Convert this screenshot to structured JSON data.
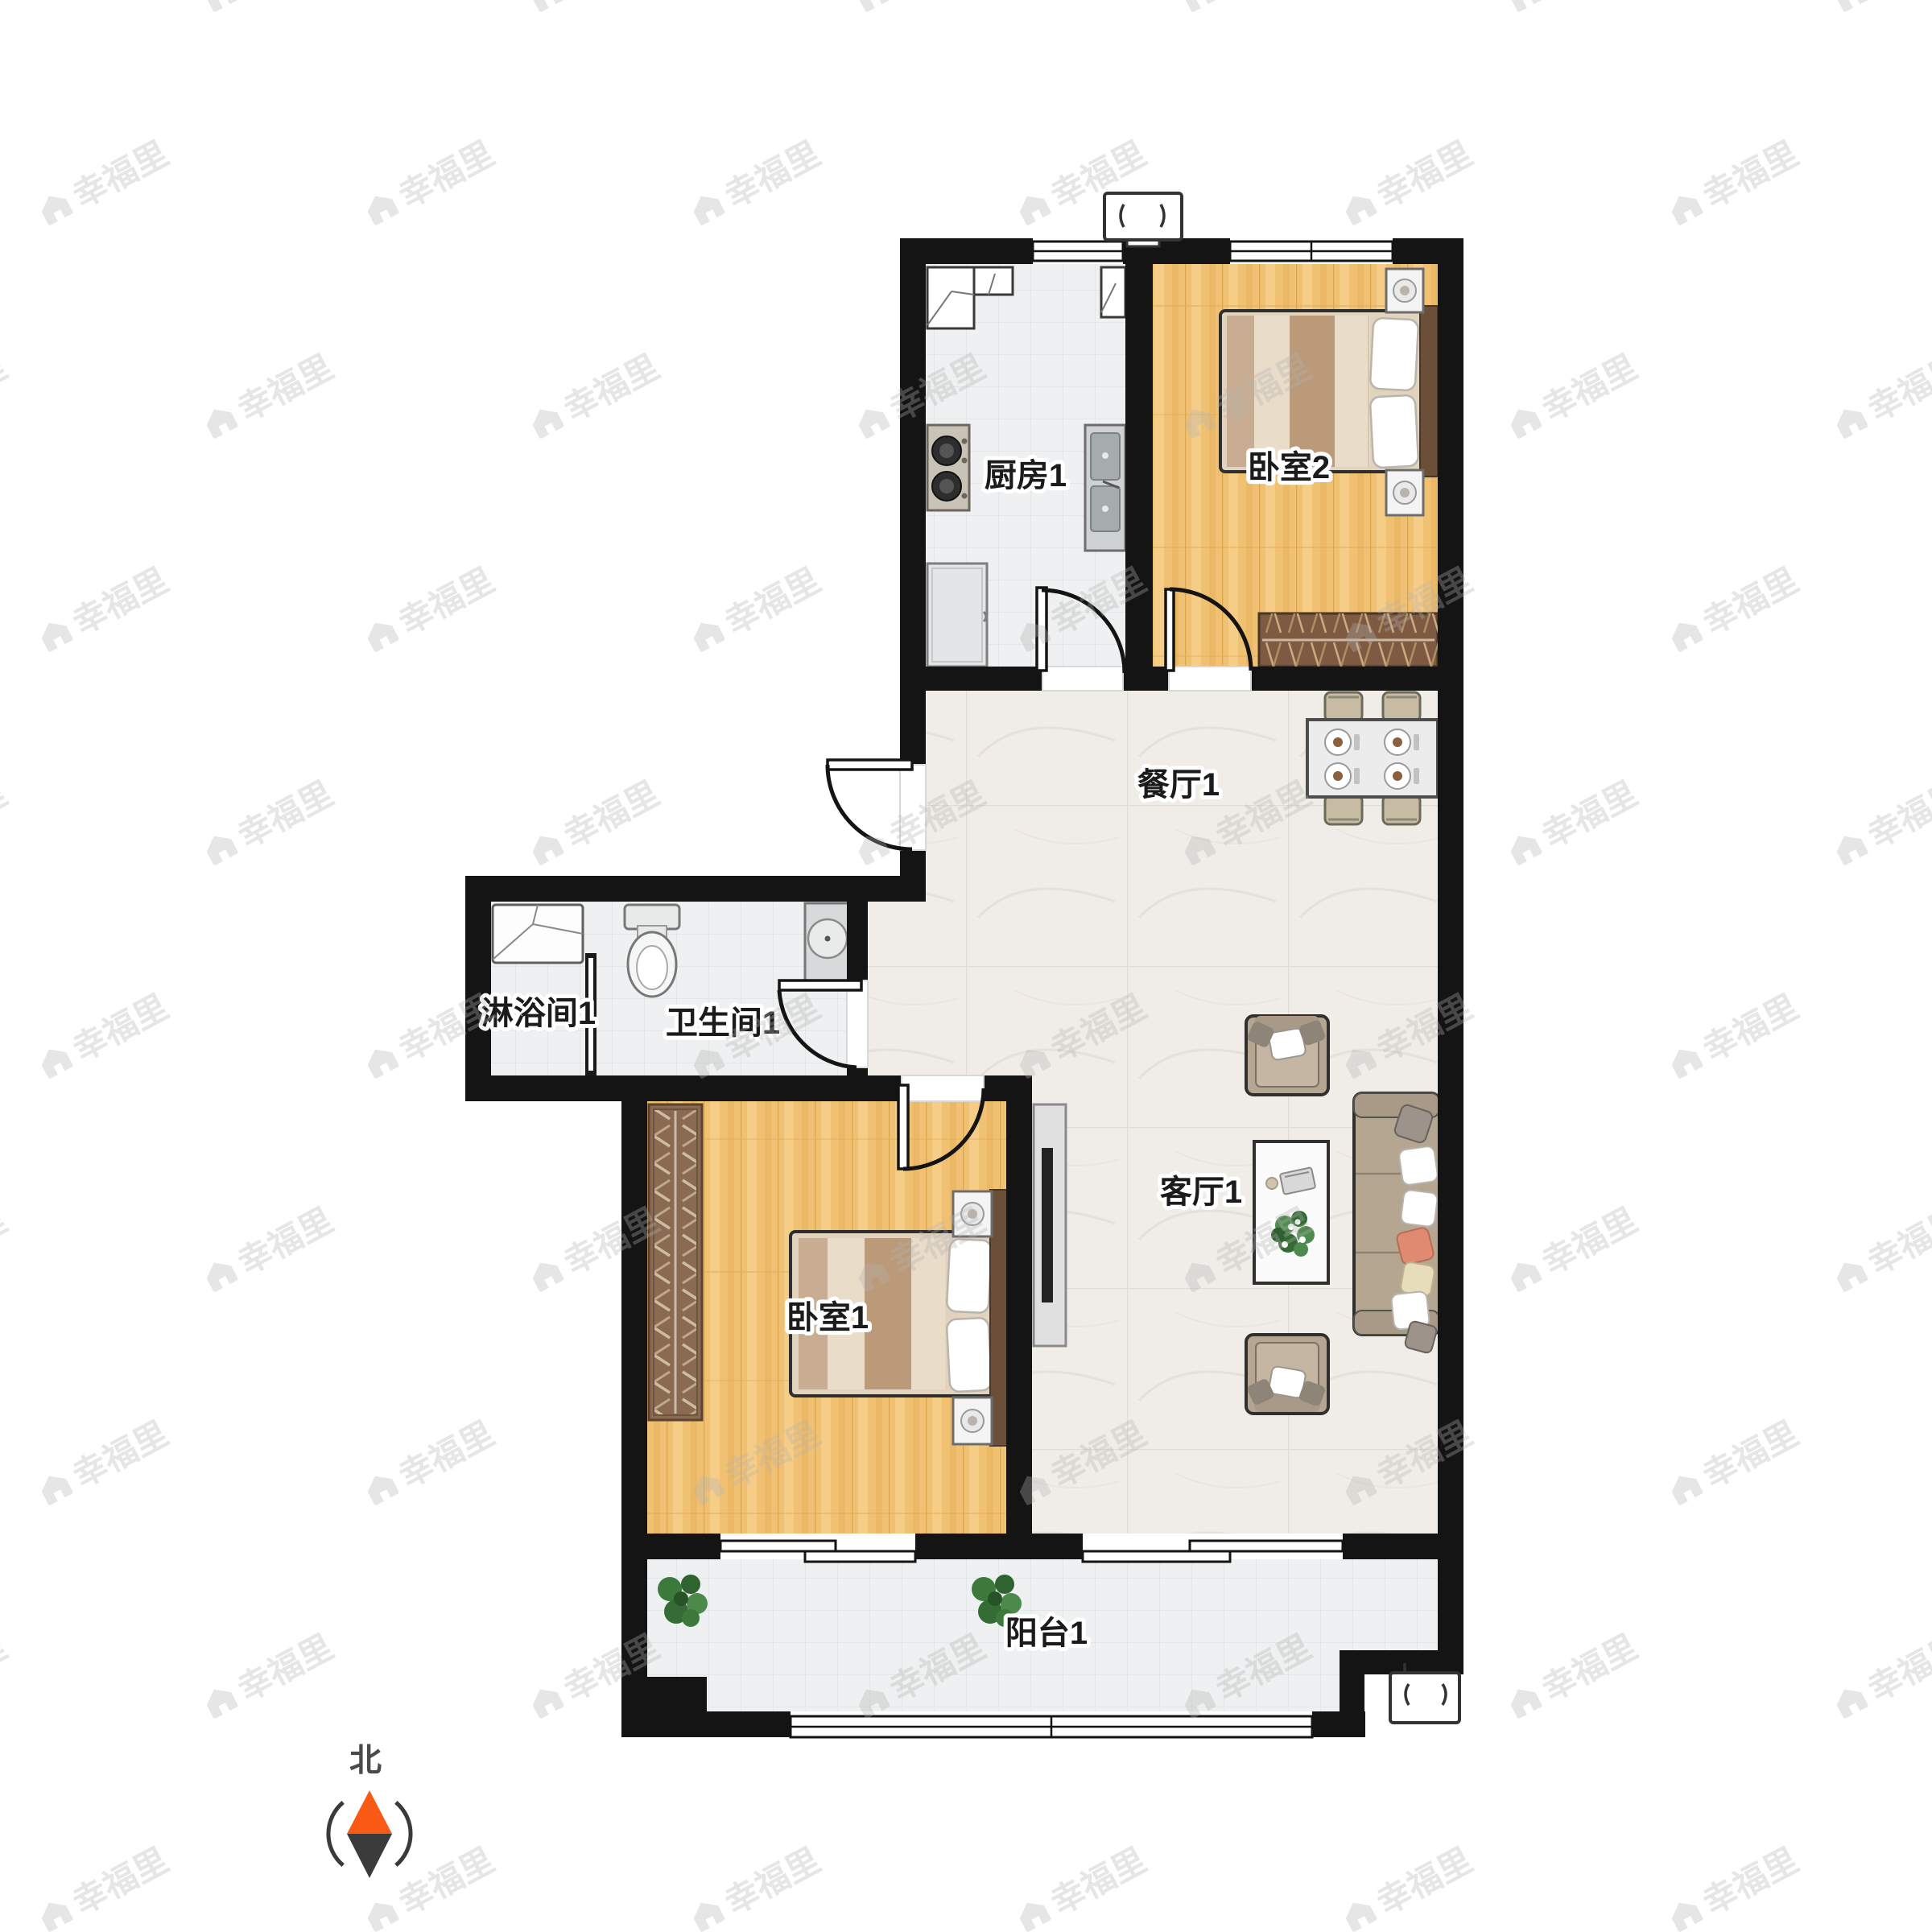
{
  "rooms": {
    "kitchen": {
      "label": "厨房1"
    },
    "bedroom2": {
      "label": "卧室2"
    },
    "dining": {
      "label": "餐厅1"
    },
    "shower": {
      "label": "淋浴间1"
    },
    "bathroom": {
      "label": "卫生间1"
    },
    "bedroom1": {
      "label": "卧室1"
    },
    "living": {
      "label": "客厅1"
    },
    "balcony": {
      "label": "阳台1"
    }
  },
  "compass": {
    "north_label": "北",
    "needle_top_color": "#f95a16",
    "needle_bottom_color": "#3b3b3b"
  },
  "watermark": {
    "text": "幸福里"
  },
  "colors": {
    "wall": "#141414",
    "wood_floor": "#f1c173",
    "tile_floor": "#eef0f1",
    "marble_floor": "#f0ede8",
    "furniture_wood_dark": "#6b4f38",
    "sofa_fabric": "#b5a692",
    "accent_pillow": "#e08a72",
    "plant_green": "#3c7a3c"
  }
}
